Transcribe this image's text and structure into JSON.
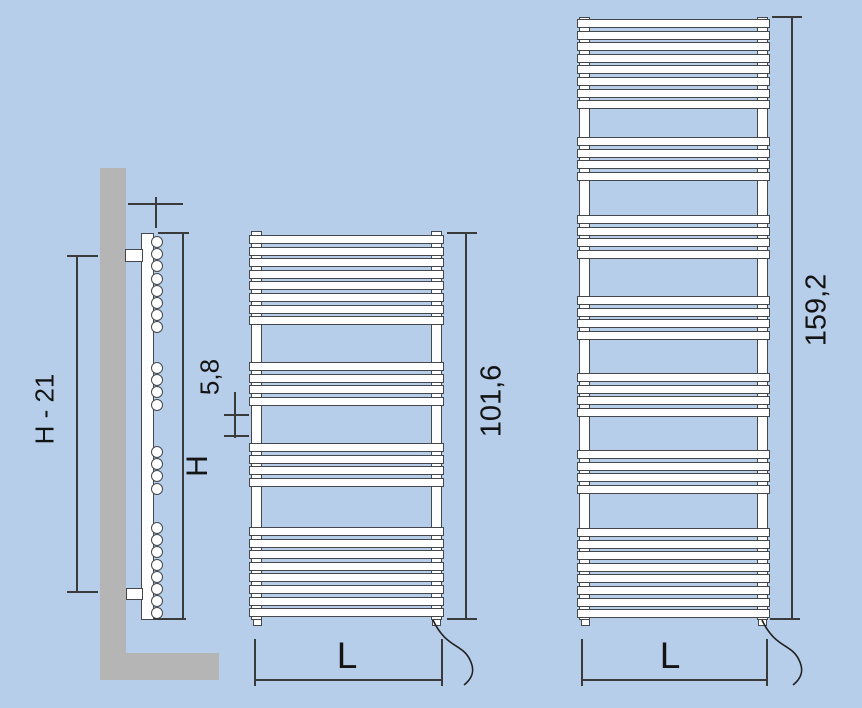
{
  "diagram": {
    "type": "towel-radiator-technical-drawing",
    "colors": {
      "background": "#b7ceeb",
      "wall": "#b5b5b5",
      "line": "#3a3a3a",
      "part_fill": "#ffffff",
      "part_stroke": "#44484c"
    },
    "side_view": {
      "bracket_distance_label": "H - 21",
      "total_height_label": "H",
      "depth_label": "5,8",
      "circle_groups": [
        8,
        4,
        4,
        8
      ]
    },
    "medium_radiator": {
      "height_label": "101,6",
      "width_label": "L",
      "bar_groups": [
        8,
        4,
        4,
        8
      ]
    },
    "tall_radiator": {
      "height_label": "159,2",
      "width_label": "L",
      "bar_groups": [
        8,
        4,
        4,
        4,
        4,
        4,
        8
      ]
    }
  }
}
